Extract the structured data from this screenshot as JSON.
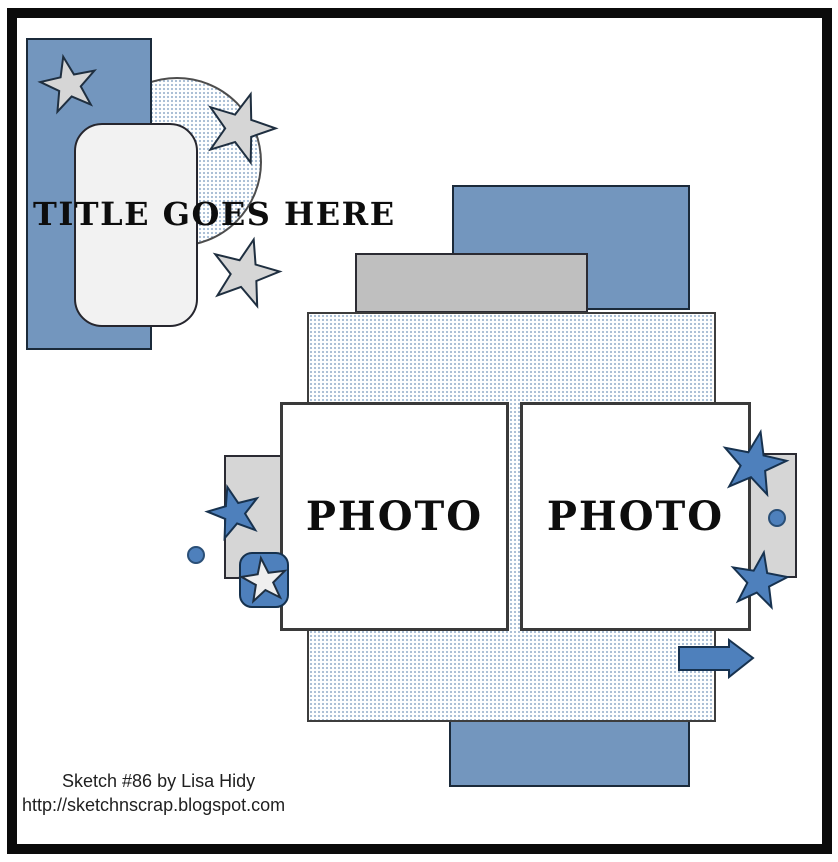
{
  "sketch": {
    "name": "Sketch #86",
    "title_placeholder": "TITLE GOES HERE",
    "photo_left_label": "PHOTO",
    "photo_right_label": "PHOTO"
  },
  "footer": {
    "credit": "Sketch #86 by Lisa Hidy",
    "url": "http://sketchnscrap.blogspot.com"
  },
  "colors": {
    "panel_blue": "#7396BE",
    "accent_blue": "#4E80BC",
    "gray_mid": "#BFBFBF",
    "gray_light": "#D6D6D6",
    "card_white": "#F2F2F2",
    "dot_pattern": "#A7BCD4",
    "outline_dark": "#1B2A3A",
    "frame_black": "#0B0B0B"
  }
}
